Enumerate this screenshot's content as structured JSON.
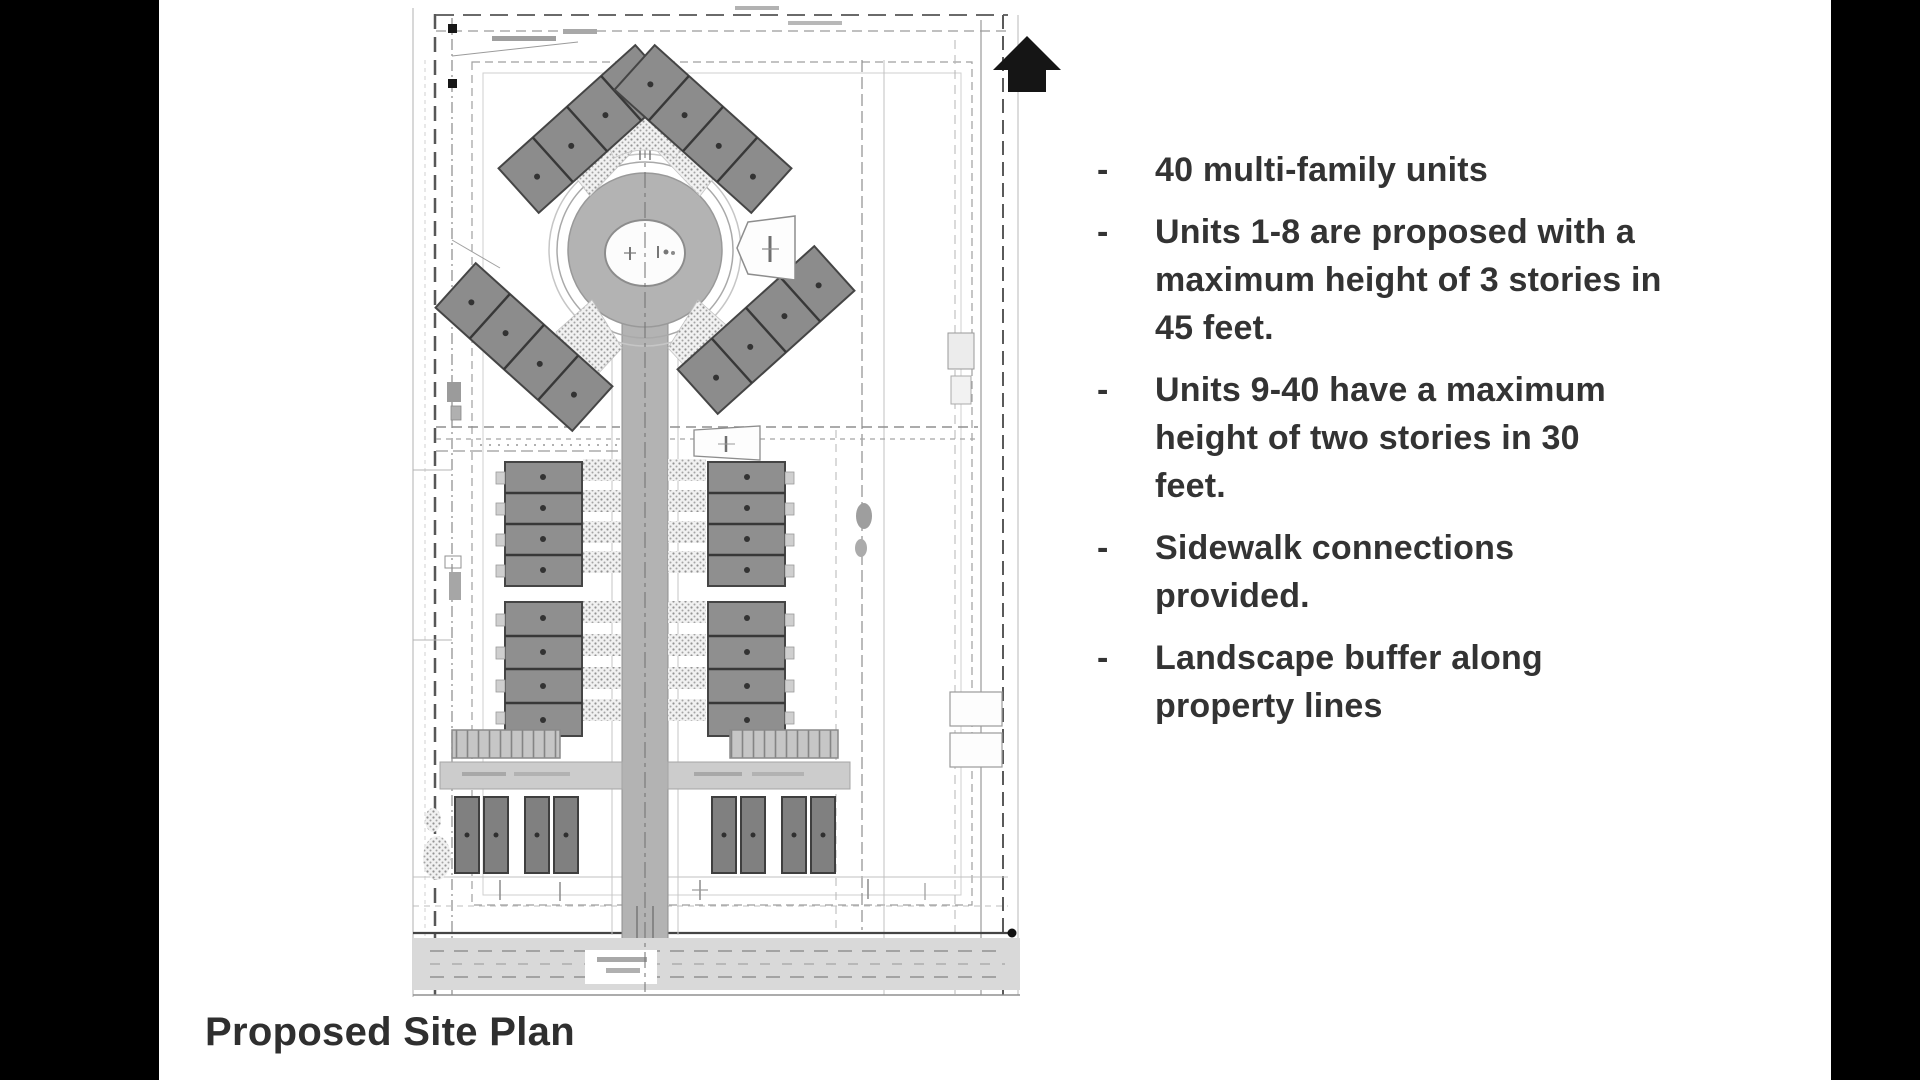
{
  "slide": {
    "caption": "Proposed Site Plan",
    "bullet_marker": "-",
    "bullets": [
      {
        "lines": [
          "40 multi-family units"
        ]
      },
      {
        "lines": [
          "Units 1-8 are proposed with a",
          "maximum height of 3 stories in",
          "45 feet."
        ]
      },
      {
        "lines": [
          "Units 9-40 have a maximum",
          "height of two stories in 30",
          "feet."
        ]
      },
      {
        "lines": [
          "Sidewalk connections",
          "provided."
        ]
      },
      {
        "lines": [
          "Landscape buffer along",
          "property lines"
        ]
      }
    ]
  },
  "site_plan": {
    "north_arrow_direction": "up",
    "visible_elements": [
      "dashed property boundary",
      "central cul-de-sac with landscaped island",
      "four angled 4-unit building clusters around cul-de-sac",
      "four straight 4-unit building rows along central road",
      "parking stalls and garage buildings at south end",
      "bottom frontage road"
    ]
  },
  "colors": {
    "letterbox": "#000000",
    "slide-bg": "#ffffff",
    "text": "#333333",
    "building-gray": "#8c8c8c",
    "garage-gray": "#808080",
    "road-gray": "#b3b3b3",
    "boundary-dark": "#444444"
  }
}
